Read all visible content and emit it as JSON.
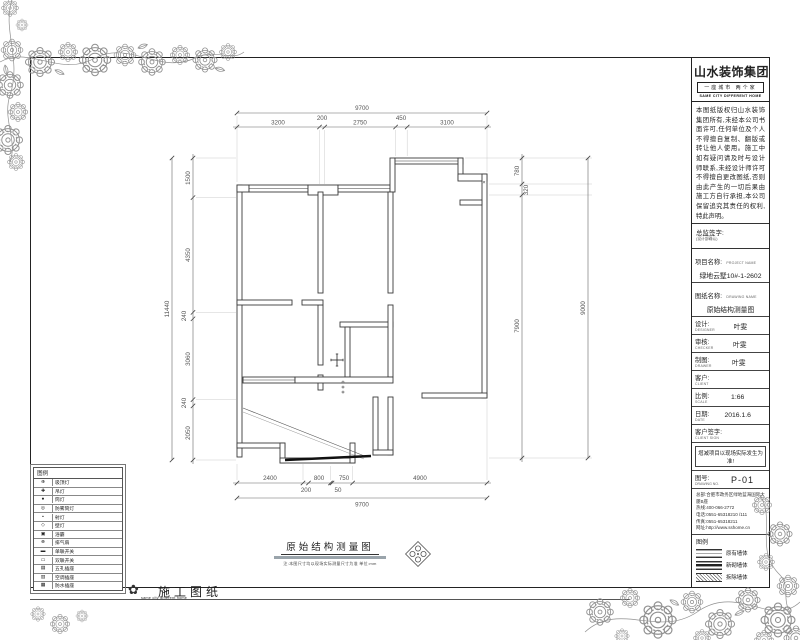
{
  "logo": {
    "name": "山水装饰集团",
    "strip": "一座城市 两个家",
    "tagline": "SAME CITY DIFFERENT HOME"
  },
  "notes": {
    "body": "本图纸版权归山水装饰集团所有,未经本公司书面许可,任何单位及个人不得擅自复制、翻版或转让他人使用。施工中如有疑问请及时与设计师联系,未经设计师许可不得擅自更改图纸,否则由此产生的一切后果由施工方自行承担,本公司保留追究其责任的权利,特此声明。",
    "sign_label": "总监签字:",
    "sign_sub": "(设计部确认)"
  },
  "fields": [
    {
      "label": "项目名称:",
      "en": "PROJECT NAME",
      "value": "绿地云墅10#-1-2602",
      "mode": "block"
    },
    {
      "label": "图纸名称:",
      "en": "DRAWING NAME",
      "value": "原始结构测量图",
      "mode": "block"
    },
    {
      "label": "设计:",
      "en": "DESIGNER",
      "value": "叶雯",
      "mode": "inline"
    },
    {
      "label": "审核:",
      "en": "CHECKER",
      "value": "叶雯",
      "mode": "inline"
    },
    {
      "label": "制图:",
      "en": "DRAWER",
      "value": "叶雯",
      "mode": "inline"
    },
    {
      "label": "客户:",
      "en": "CLIENT",
      "value": "",
      "mode": "inline"
    },
    {
      "label": "比例:",
      "en": "SCALE",
      "value": "1:66",
      "mode": "inline"
    },
    {
      "label": "日期:",
      "en": "DATE",
      "value": "2016.1.6",
      "mode": "inline"
    },
    {
      "label": "客户签字:",
      "en": "CLIENT SIGN",
      "value": "",
      "mode": "inline"
    }
  ],
  "notice": "增减项目以现场实际发生为准!",
  "sheet_no": {
    "label": "图号:",
    "en": "DRAWING NO.",
    "value": "P-01"
  },
  "company": [
    "总部:合肥市政务区绿地蓝海国际大厦B座",
    "热线:400-066-2772",
    "电话:0551-65318210 /111",
    "传真:0551-65318211",
    "网址:http://www.sshome.cn"
  ],
  "wall_legend": {
    "title": "图例",
    "items": [
      {
        "label": "原有墙体",
        "type": "orig"
      },
      {
        "label": "新砌墙体",
        "type": "new"
      },
      {
        "label": "拆除墙体",
        "type": "demo"
      }
    ]
  },
  "legend": {
    "title": "图例",
    "rows": [
      {
        "sym": "⊕",
        "label": "吸顶灯"
      },
      {
        "sym": "✚",
        "label": "吊灯"
      },
      {
        "sym": "●",
        "label": "筒灯"
      },
      {
        "sym": "◎",
        "label": "防雾筒灯"
      },
      {
        "sym": "•",
        "label": "射灯"
      },
      {
        "sym": "◇",
        "label": "壁灯"
      },
      {
        "sym": "▣",
        "label": "浴霸"
      },
      {
        "sym": "⊗",
        "label": "排气扇"
      },
      {
        "sym": "▬",
        "label": "单联开关"
      },
      {
        "sym": "▭",
        "label": "双联开关"
      },
      {
        "sym": "▤",
        "label": "五孔插座"
      },
      {
        "sym": "▥",
        "label": "空调插座"
      },
      {
        "sym": "▦",
        "label": "防水插座"
      }
    ]
  },
  "caption": {
    "title": "原始结构测量图",
    "sub": "注:本图尺寸均以现场实际测量尺寸为准  单位:mm"
  },
  "footer": {
    "tagline": "same city different home",
    "title": "施工图纸"
  },
  "plan": {
    "dims": {
      "top": {
        "overall": "9700",
        "segs": [
          "3200",
          "200",
          "2750",
          "450",
          "3100"
        ]
      },
      "bottom": {
        "overall": "9700",
        "segs": [
          "2400",
          "200",
          "800",
          "50",
          "750",
          "4900"
        ]
      },
      "left": {
        "overall": "11440",
        "segs": [
          "1500",
          "4350",
          "240",
          "3060",
          "240",
          "2050"
        ]
      },
      "right": {
        "overall": "9000",
        "segs": [
          "780",
          "320",
          "7900"
        ]
      }
    },
    "markers": {
      "corner_x": "×"
    }
  }
}
